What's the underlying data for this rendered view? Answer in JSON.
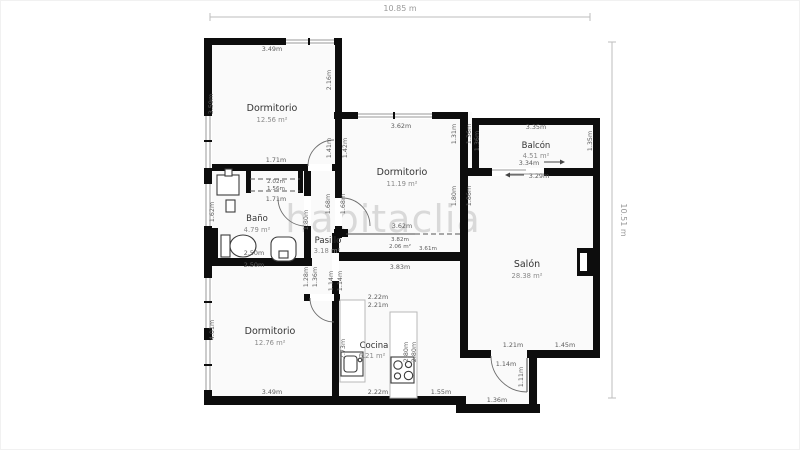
{
  "watermark": "habitaclia",
  "dimensions": {
    "width": "10.85 m",
    "height": "10.51 m"
  },
  "rooms": {
    "bedroom_top": {
      "name": "Dormitorio",
      "area": "12.56 m²"
    },
    "bedroom_mid": {
      "name": "Dormitorio",
      "area": "11.19 m²"
    },
    "bedroom_bottom": {
      "name": "Dormitorio",
      "area": "12.76 m²"
    },
    "bathroom": {
      "name": "Baño",
      "area": "4.79 m²"
    },
    "hallway": {
      "name": "Pasillo",
      "area": "3.18 m²"
    },
    "living": {
      "name": "Salón",
      "area": "28.38 m²"
    },
    "kitchen": {
      "name": "Cocina",
      "area": "6.21 m²"
    },
    "balcony": {
      "name": "Balcón",
      "area": "4.51 m²"
    },
    "closet": {
      "area": "2.06 m²"
    }
  },
  "measurements": {
    "d1_top": "3.49m",
    "d1_left": "3.59m",
    "d1_right_upper": "2.16m",
    "d1_right_lower": "1.41m",
    "d2_left_upper": "1.42m",
    "d1_bottom": "1.71m",
    "closet_top": "2.02m",
    "closet_width": "1.56m",
    "closet_bottom": "1.71m",
    "bath_left": "1.62m",
    "bath_right": "1.80m",
    "bath_bottom_in": "2.50m",
    "bath_bottom_out": "2.50m",
    "d2_top": "3.62m",
    "d2_right_upper_in": "1.31m",
    "d2_right_upper_out": "1.36m",
    "d2_right_lower_in": "1.80m",
    "d2_right_lower_out": "1.86m",
    "d2_door_in": "1.68m",
    "d2_door_out": "1.68m",
    "d2_bottom": "3.62m",
    "closet2_top": "3.82m",
    "closet2_bottom": "3.61m",
    "closet2_below": "3.83m",
    "balcony_top": "3.35m",
    "balcony_left": "1.36m",
    "balcony_right": "1.35m",
    "balcony_bottom": "3.34m",
    "balcony_door": "3.29m",
    "salon_bottom_left": "1.21m",
    "salon_bottom_right": "1.45m",
    "entry_top": "1.14m",
    "entry_door": "1.11m",
    "entry_bottom": "1.36m",
    "d3_left": "4.01m",
    "d3_bottom": "3.49m",
    "d3_right_upper_in": "1.28m",
    "d3_right_upper_out": "1.36m",
    "hall_end_in": "1.14m",
    "hall_end_out": "1.14m",
    "d3_right_lower": "2.73m",
    "kitchen_top_a": "2.22m",
    "kitchen_top_b": "2.21m",
    "kitchen_right_a": "2.80m",
    "kitchen_right_b": "2.80m",
    "kitchen_bottom": "2.22m",
    "kitchen_bottom_right": "1.55m"
  }
}
